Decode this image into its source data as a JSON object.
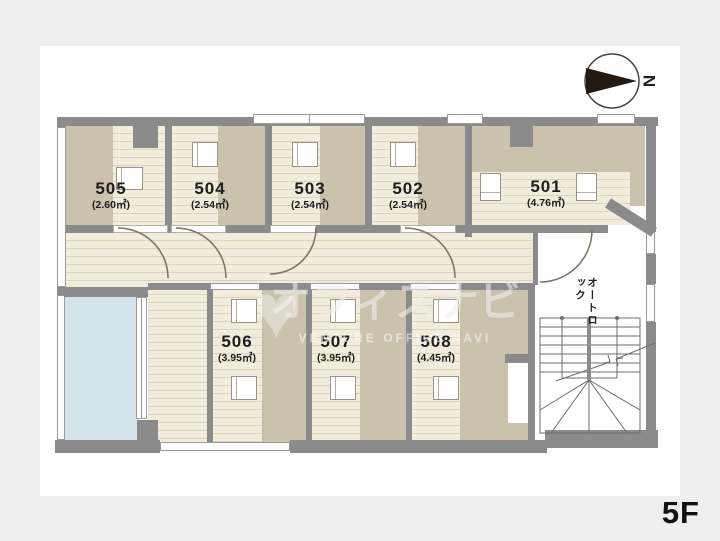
{
  "floor": {
    "label": "5F"
  },
  "compass": {
    "letter": "N"
  },
  "entrance": {
    "auto_lock_label": "オートロック"
  },
  "rooms": [
    {
      "number": "501",
      "area": "(4.76㎡)"
    },
    {
      "number": "502",
      "area": "(2.54㎡)"
    },
    {
      "number": "503",
      "area": "(2.54㎡)"
    },
    {
      "number": "504",
      "area": "(2.54㎡)"
    },
    {
      "number": "505",
      "area": "(2.60㎡)"
    },
    {
      "number": "506",
      "area": "(3.95㎡)"
    },
    {
      "number": "507",
      "area": "(3.95㎡)"
    },
    {
      "number": "508",
      "area": "(4.45㎡)"
    }
  ],
  "watermark": {
    "jp": "オフィスナビ",
    "en": "VENTURE OFFICE NAVI",
    "heart": "♥"
  },
  "colors": {
    "wall": "#8b8b8b",
    "tatami": "#cbc2ae",
    "floor_base": "#f2ecdd",
    "balcony": "#d4e2ea",
    "background": "#efefef"
  }
}
